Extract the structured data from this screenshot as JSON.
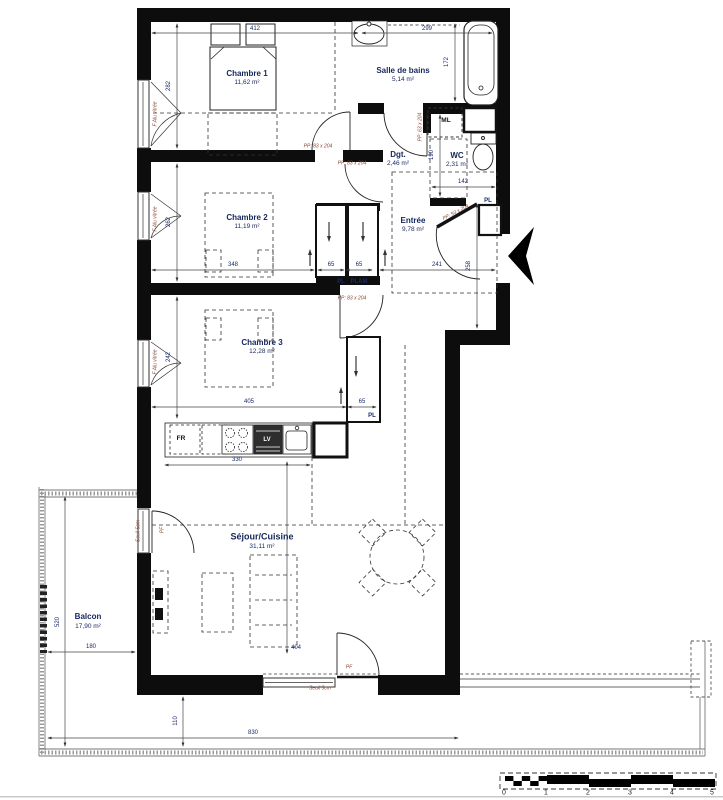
{
  "plan": {
    "rooms": [
      {
        "name": "Chambre 1",
        "area": "11,62 m²"
      },
      {
        "name": "Salle de bains",
        "area": "5,14 m²"
      },
      {
        "name": "WC",
        "area": "2,31 m²"
      },
      {
        "name": "Dgt.",
        "area": "2,46 m²"
      },
      {
        "name": "Entrée",
        "area": "9,78 m²"
      },
      {
        "name": "Chambre 2",
        "area": "11,19 m²"
      },
      {
        "name": "Chambre 3",
        "area": "12,28 m²"
      },
      {
        "name": "Séjour/Cuisine",
        "area": "31,11 m²"
      },
      {
        "name": "Balcon",
        "area": "17,90 m²"
      }
    ],
    "appliances": {
      "washing_machine": "ML",
      "fridge": "FR",
      "dishwasher": "LV"
    },
    "closets": {
      "pl_left": "PL",
      "pl_right": "PLAM",
      "pl_ch3": "PL",
      "pl_entree": "PL"
    },
    "door_labels": {
      "pp83": "PP: 83 x 204",
      "pp63": "PP: 63 x 204",
      "pp93": "PP: 93 x 204"
    },
    "window_labels": {
      "bay": "F Alu vitrée",
      "threshold": "Seuil 5cm",
      "french_door": "PF"
    },
    "dims": {
      "d412": "412",
      "d299": "299",
      "d282": "282",
      "d262": "262",
      "d242": "242",
      "d172": "172",
      "d190": "190",
      "d142": "142",
      "d65a": "65",
      "d65b": "65",
      "d241": "241",
      "d258": "258",
      "d348": "348",
      "d405": "405",
      "d65c": "65",
      "d330": "330",
      "d404": "404",
      "d180": "180",
      "d520": "520",
      "d110": "110",
      "d830": "830"
    },
    "scale": {
      "t0": "0",
      "t1": "1",
      "t2": "2",
      "t3": "3",
      "t4": "4",
      "t5": "5"
    }
  }
}
